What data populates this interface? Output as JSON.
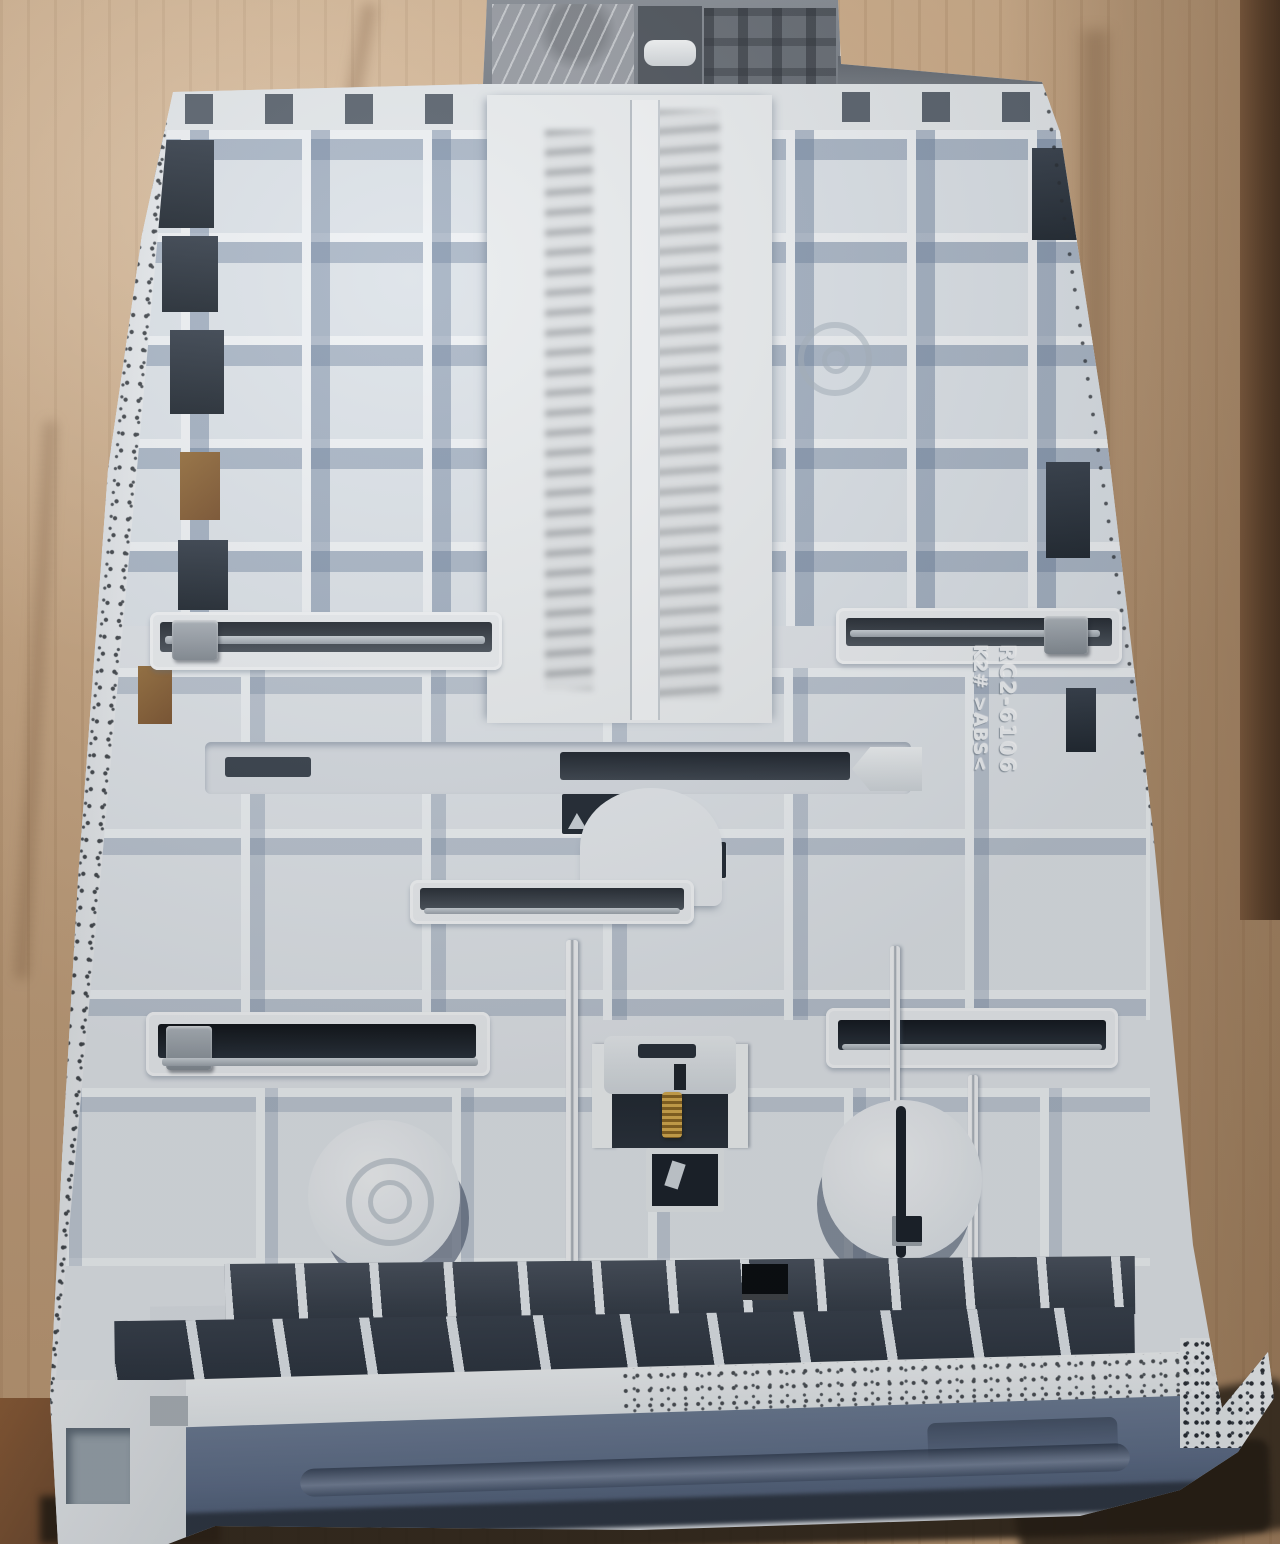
{
  "photo": {
    "subject_text": {
      "part_number": "RC2-6106",
      "material_code": "K2# >ABS<"
    },
    "colors": {
      "cardboard": "#c6a37e",
      "cardboard_dark_edge": "#5d422c",
      "tray_plastic": "#dfe3e8",
      "rib_highlight": "#eef1f4",
      "recess_shadow": "#6c809c",
      "deep_recess": "#2c343f",
      "front_edge_blue": "#5d6c86",
      "slider_clip_gray": "#98a0a7",
      "mechanism_gray": "#7d838b",
      "spring_brass": "#b8913f"
    }
  }
}
